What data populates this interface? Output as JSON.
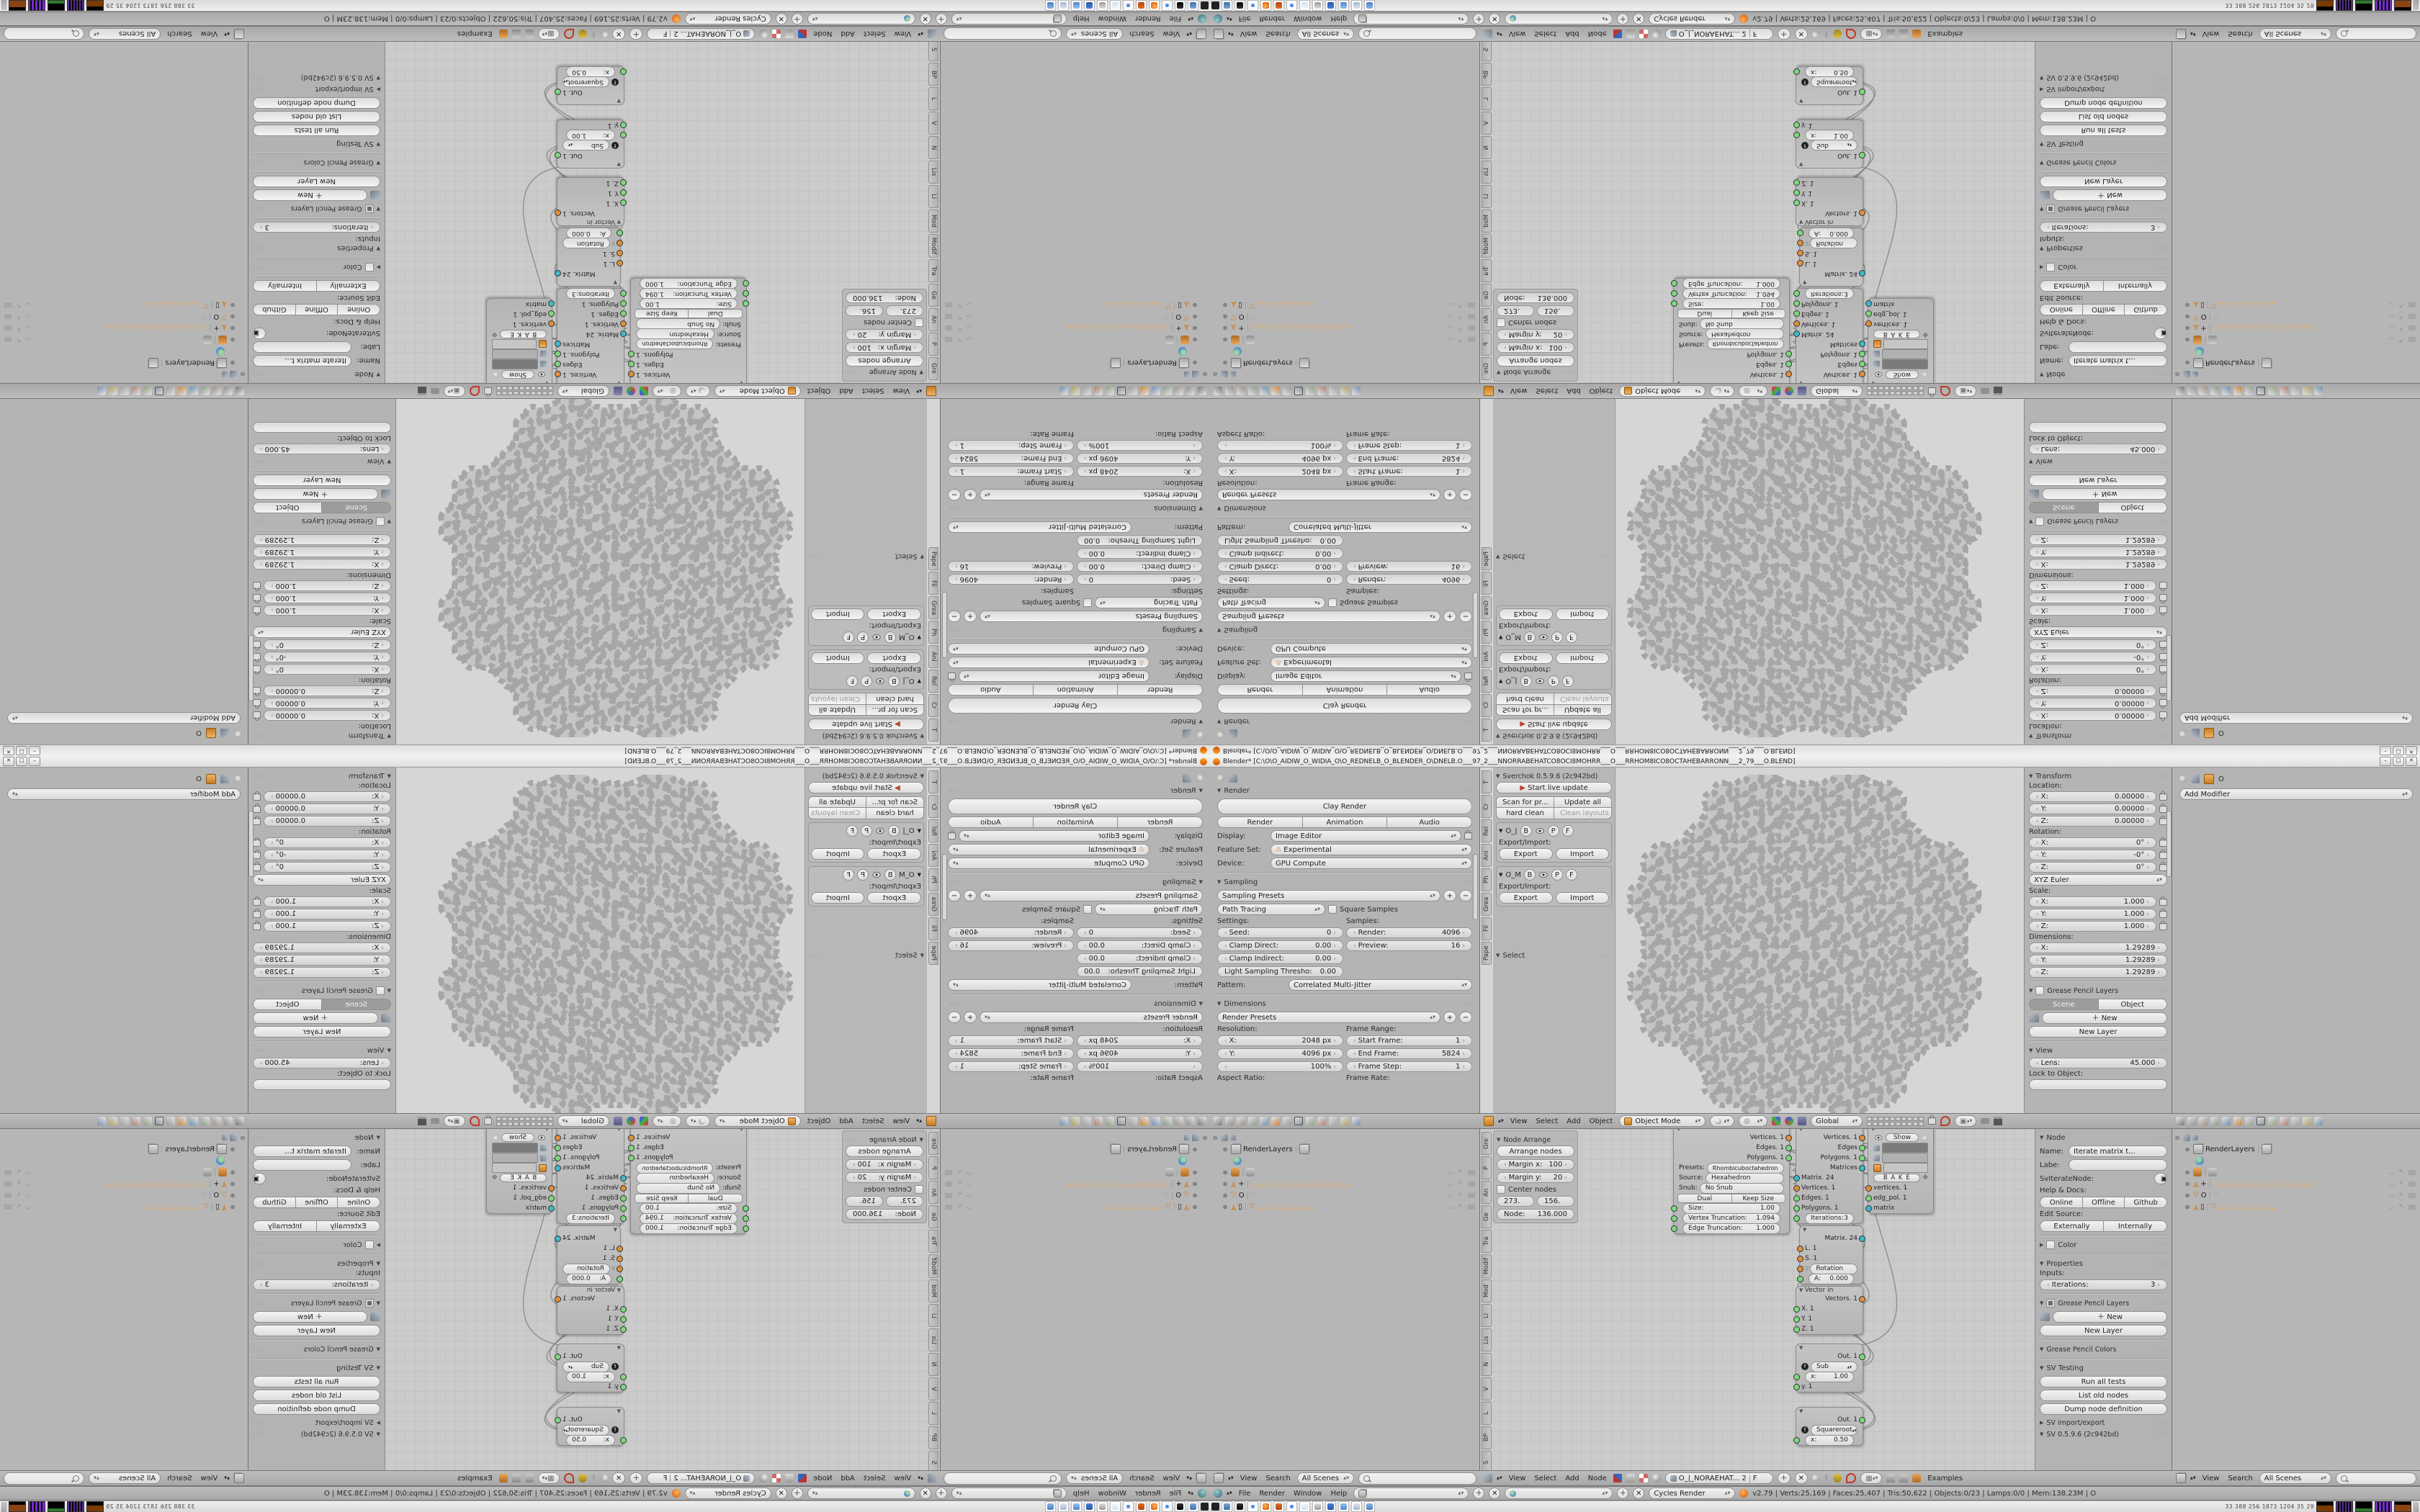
{
  "accent_colors": {
    "socket_orange": "#e08f3c",
    "socket_green": "#7fd67f",
    "socket_teal": "#3fb8c9",
    "blender_orange": "#e87d0d",
    "bone_tan": "#d8ad7e"
  },
  "window": {
    "title": "Blender* [C:\\O\\O_AIDIW_O_WIDIA_O\\O_REDNELB_O_BLENDER_O\\DNELB.O___97_2___NNORRABEHATCO8OCI8MOHRR___O___RRHOM8ICO8OCTAHEBARRONN___2_79___O.BLEND]",
    "minimize": "–",
    "maximize": "□",
    "close": "✕"
  },
  "props_left": {
    "object_breadcrumb": "",
    "render_panel": "Render",
    "clay_render": "Clay Render",
    "render_btn": "Render",
    "animation_btn": "Animation",
    "audio_btn": "Audio",
    "display_label": "Display:",
    "display_value": "Image Editor",
    "feature_label": "Feature Set:",
    "feature_value": "Experimental",
    "feature_warn": "⚠",
    "device_label": "Device:",
    "device_value": "GPU Compute",
    "sampling_panel": "Sampling",
    "sampling_presets": "Sampling Presets",
    "path_tracing": "Path Tracing",
    "square_samples": "Square Samples",
    "settings_label": "Settings:",
    "samples_label": "Samples:",
    "seed_label": "Seed:",
    "seed": "0",
    "render_s_label": "Render:",
    "render_s": "4096",
    "clamp_d_label": "Clamp Direct:",
    "clamp_d": "0.00",
    "preview_label": "Preview:",
    "preview": "16",
    "clamp_i_label": "Clamp Indirect:",
    "clamp_i": "0.00",
    "light_s_label": "Light Sampling Thresho:",
    "light_s": "0.00",
    "pattern_label": "Pattern:",
    "pattern": "Correlated Multi-Jitter",
    "dimensions_panel": "Dimensions",
    "render_presets": "Render Presets",
    "resolution_label": "Resolution:",
    "frame_range_label": "Frame Range:",
    "res_x_label": "X:",
    "res_x": "2048 px",
    "res_y_label": "Y:",
    "res_y": "4096 px",
    "res_pct": "100%",
    "start_f_label": "Start Frame:",
    "start_f": "1",
    "end_f_label": "End Frame:",
    "end_f": "5824",
    "step_f_label": "Frame Step:",
    "step_f": "1",
    "aspect_label": "Aspect Ratio:",
    "frame_rate_label": "Frame Rate:"
  },
  "props_tabs": [
    "editor-select",
    "render",
    "render-layers",
    "scene",
    "world",
    "object",
    "constraints",
    "modifiers",
    "data",
    "material",
    "texture",
    "particles",
    "physics"
  ],
  "props_right": {
    "object_name": "O",
    "add_modifier": "Add Modifier"
  },
  "tshelf": {
    "tabs": [
      "T",
      "Cr",
      "Rel",
      "Ani",
      "Ph",
      "Grea",
      "Fil",
      "Pape"
    ],
    "panel_title": "Sverchok 0.5.9.6 (2c942bd)",
    "start_live": "Start live update",
    "scan": "Scan for pr...",
    "update_all": "Update all",
    "hard_clean": "hard clean",
    "clean_layouts": "Clean layouts",
    "sub1": "O_|",
    "sub2": "O_M",
    "tog_b": "B",
    "tog_p": "P",
    "tog_f": "F",
    "export_import": "Export/Import:",
    "export": "Export",
    "import": "Import",
    "select_panel": "Select"
  },
  "view3d_header": {
    "menus": [
      "View",
      "Select",
      "Add",
      "Object"
    ],
    "mode": "Object Mode",
    "orientation": "Global"
  },
  "npanel": {
    "transform": "Transform",
    "location_label": "Location:",
    "loc_x_l": "X:",
    "loc_x": "0.00000",
    "loc_y_l": "Y:",
    "loc_y": "0.00000",
    "loc_z_l": "Z:",
    "loc_z": "0.00000",
    "rotation_label": "Rotation:",
    "rot_x_l": "X:",
    "rot_x": "0°",
    "rot_y_l": "Y:",
    "rot_y": "-0°",
    "rot_z_l": "Z:",
    "rot_z": "0°",
    "euler": "XYZ Euler",
    "scale_label": "Scale:",
    "scl_x_l": "X:",
    "scl_x": "1.000",
    "scl_y_l": "Y:",
    "scl_y": "1.000",
    "scl_z_l": "Z:",
    "scl_z": "1.000",
    "dim_label": "Dimensions:",
    "dim_x_l": "X:",
    "dim_x": "1.29289",
    "dim_y_l": "Y:",
    "dim_y": "1.29289",
    "dim_z_l": "Z:",
    "dim_z": "1.29289",
    "gp_layers": "Grease Pencil Layers",
    "scene_tab": "Scene",
    "object_tab": "Object",
    "new_btn": "New",
    "new_layer": "New Layer",
    "view_panel": "View",
    "lens_label": "Lens:",
    "lens": "45.000",
    "lock_label": "Lock to Object:"
  },
  "node_arrange": {
    "title": "Node Arrange",
    "arrange": "Arrange nodes",
    "margin_x_l": "Margin x:",
    "margin_x": "100",
    "margin_y_l": "Margin y:",
    "margin_y": "20",
    "center": "Center nodes",
    "f1": "273.",
    "f2": "156.",
    "node_l": "Node:",
    "node_v": "136.000"
  },
  "node_tabs": [
    "Gre",
    "P",
    "An",
    "Ge",
    "Tra",
    "Modif",
    "Mod",
    "Li",
    "Lis",
    "N",
    "V",
    "L",
    "BP",
    "S",
    "L",
    "N",
    "Bet",
    "G"
  ],
  "nodes": {
    "gen": {
      "out1": "Vertices. 1",
      "out2": "Edges. 1",
      "out3": "Polygons. 1",
      "presets_l": "Presets:",
      "presets": "Rhombicuboctahedron",
      "source_l": "Source:",
      "source": "Hexahedron",
      "snub_l": "Snub:",
      "snub": "No Snub",
      "dual": "Dual",
      "keep": "Keep Size",
      "size_l": "Size:",
      "size": "1.00",
      "vt_l": "Vertex Truncation:",
      "vt": "1.094",
      "et_l": "Edge Truncation:",
      "et": "1.000"
    },
    "iter": {
      "out1": "Vertices. 1",
      "out2": "Edges",
      "out3": "Polygons. 1",
      "out4": "Matrices",
      "in1": "Matrix. 24",
      "in2": "Vertices. 1",
      "in3": "Edges. 1",
      "in4": "Polygons. 1",
      "iter_l": "Iterations:",
      "iter": "3"
    },
    "show": {
      "eye": "👁",
      "title": "Show",
      "bake": "B A K E",
      "out1": "vertices. 1",
      "out2": "edg_pol. 1",
      "out3": "matrix"
    },
    "matrix": {
      "out": "Matrix. 24",
      "in1": "L. 1",
      "in2": "S. 1",
      "rot": "Rotation",
      "a_l": "A:",
      "a": "0.000"
    },
    "vector": {
      "title": "Vector in",
      "out": "Vectors. 1",
      "in1": "X. 1",
      "in2": "Y. 1",
      "in3": "Z. 1"
    },
    "sub": {
      "out": "Out. 1",
      "fn": "Sub",
      "x_l": "x:",
      "x": "1.00",
      "y": "y. 1"
    },
    "sqrt": {
      "out": "Out. 1",
      "fn": "Squareroot",
      "x_l": "x:",
      "x": "0.50"
    }
  },
  "node_npanel": {
    "title": "Node",
    "name_l": "Name:",
    "name": "Iterate matrix t...",
    "label_l": "Labe:",
    "idname": "SvIterateNode:",
    "help": "Help & Docs:",
    "online": "Online",
    "offline": "Offline",
    "github": "Github",
    "edit_src": "Edit Source:",
    "externally": "Externally",
    "internally": "Internally",
    "color": "Color",
    "properties": "Properties",
    "inputs_l": "Inputs:",
    "iter_l": "Iterations:",
    "iter": "3",
    "gp_layers": "Grease Pencil Layers",
    "new_btn": "New",
    "new_layer": "New Layer",
    "gp_colors": "Grease Pencil Colors",
    "sv_testing": "SV Testing",
    "run_tests": "Run all tests",
    "list_old": "List old nodes",
    "dump_def": "Dump node definition",
    "sv_ie": "SV import/export",
    "sv_ver": "SV 0.5.9.6 (2c942bd)"
  },
  "node_header": {
    "menus": [
      "View",
      "Select",
      "Add",
      "Node"
    ],
    "tree_name": "O_|_NORAEHAT...",
    "tree_users": "2",
    "fake_user": "F",
    "examples": "Examples"
  },
  "outliner": {
    "header_menus": [
      "View",
      "Search"
    ],
    "scenes_filter": "All Scenes",
    "search_placeholder": "",
    "root_label": "RenderLayers",
    "mesh_o_label": "O",
    "arm_plus": "+",
    "arm_box": "▯",
    "bones_row1": 14,
    "bones_row2": 8
  },
  "info_bar": {
    "menus": [
      "File",
      "Render",
      "Window",
      "Help"
    ],
    "engine": "Cycles Render",
    "stats": "v2.79 | Verts:25,169 | Faces:25,407 | Tris:50,622 | Objects:0/23 | Lamps:0/0 | Mem:138.23M | O"
  },
  "taskbar": {
    "icons": [
      "display",
      "device",
      "chrome",
      "blender",
      "spiral",
      "chrome",
      "notepad",
      "volume",
      "floppy64",
      "viewer",
      "calculator",
      "window"
    ],
    "tray_numbers": [
      "33",
      "388",
      "256",
      "1873",
      "1204",
      "35",
      "29"
    ]
  }
}
